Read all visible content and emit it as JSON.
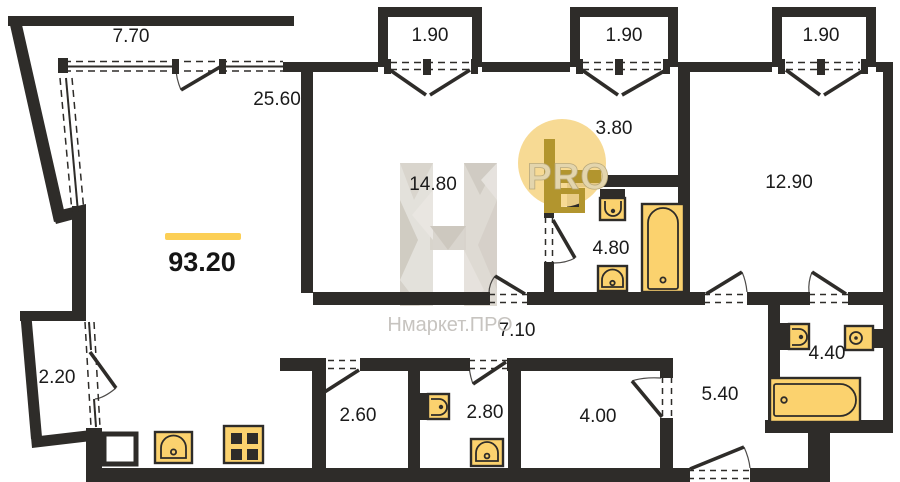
{
  "plan": {
    "total_area": {
      "value": "93.20"
    },
    "watermark": {
      "brand": "Нмаркет.ПРО",
      "badge": "PRO",
      "logo_letter_icon": "h-faceted-watermark"
    },
    "rooms": [
      {
        "id": "balcony-top-left",
        "area": "7.70"
      },
      {
        "id": "balcony-top-1",
        "area": "1.90"
      },
      {
        "id": "balcony-top-2",
        "area": "1.90"
      },
      {
        "id": "balcony-top-3",
        "area": "1.90"
      },
      {
        "id": "living-room",
        "area": "25.60"
      },
      {
        "id": "room-middle",
        "area": "14.80"
      },
      {
        "id": "hall-entry",
        "area": "3.80"
      },
      {
        "id": "bedroom-right",
        "area": "12.90"
      },
      {
        "id": "bathroom-top",
        "area": "4.80"
      },
      {
        "id": "corridor-main",
        "area": "7.10"
      },
      {
        "id": "balcony-left",
        "area": "2.20"
      },
      {
        "id": "storage-1",
        "area": "2.60"
      },
      {
        "id": "wc-guest",
        "area": "2.80"
      },
      {
        "id": "storage-2",
        "area": "4.00"
      },
      {
        "id": "corridor-entry",
        "area": "5.40"
      },
      {
        "id": "bathroom-right",
        "area": "4.40"
      }
    ],
    "fixtures": [
      "kitchen-sink-icon",
      "stove-icon",
      "toilet-icon",
      "sink-icon",
      "bathtub-icon",
      "toilet-icon",
      "sink-icon",
      "toilet-icon",
      "sink-icon",
      "bathtub-icon"
    ],
    "colors": {
      "wall": "#2e2c29",
      "fixture_fill": "#fbd26e",
      "accent_bar": "#fccf55",
      "badge_background": "#f6d78c",
      "badge_logo": "#b2952e",
      "watermark_gray": "#c7c4c0",
      "label_text": "#1b1b1b"
    }
  }
}
